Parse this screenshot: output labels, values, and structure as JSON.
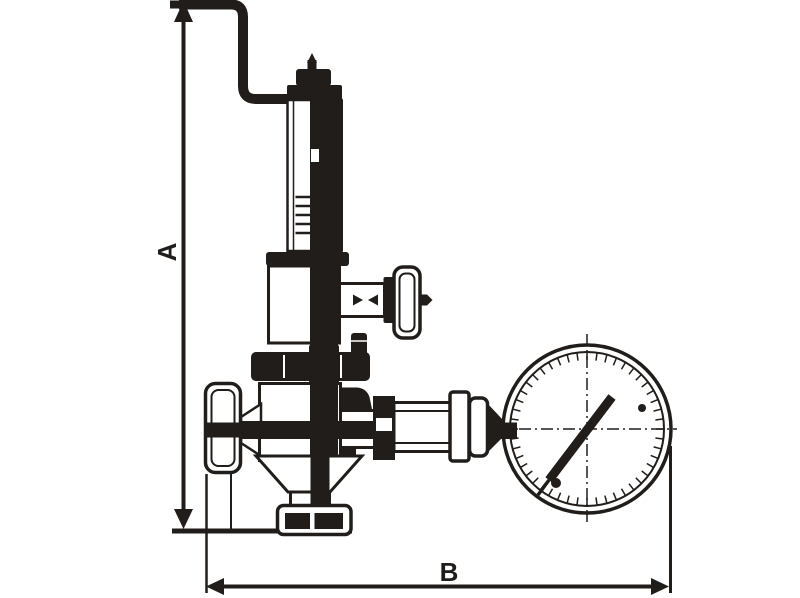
{
  "figure": {
    "type": "technical-line-drawing",
    "subject": "pressure reducing valve with gooseneck vent pipe, shut-off handwheels, outlet flange and pressure gauge"
  },
  "colors": {
    "ink": "#201d1b",
    "paper": "#ffffff"
  },
  "dimensions": {
    "a": {
      "label": "A",
      "orientation": "vertical"
    },
    "b": {
      "label": "B",
      "orientation": "horizontal"
    }
  },
  "parts": [
    "gooseneck-pipe",
    "adjusting-screw",
    "spring-housing",
    "side-handwheel",
    "union-nut",
    "inlet-handwheel",
    "valve-body",
    "outlet-flange",
    "gauge-piping",
    "pressure-gauge",
    "gauge-needle"
  ]
}
